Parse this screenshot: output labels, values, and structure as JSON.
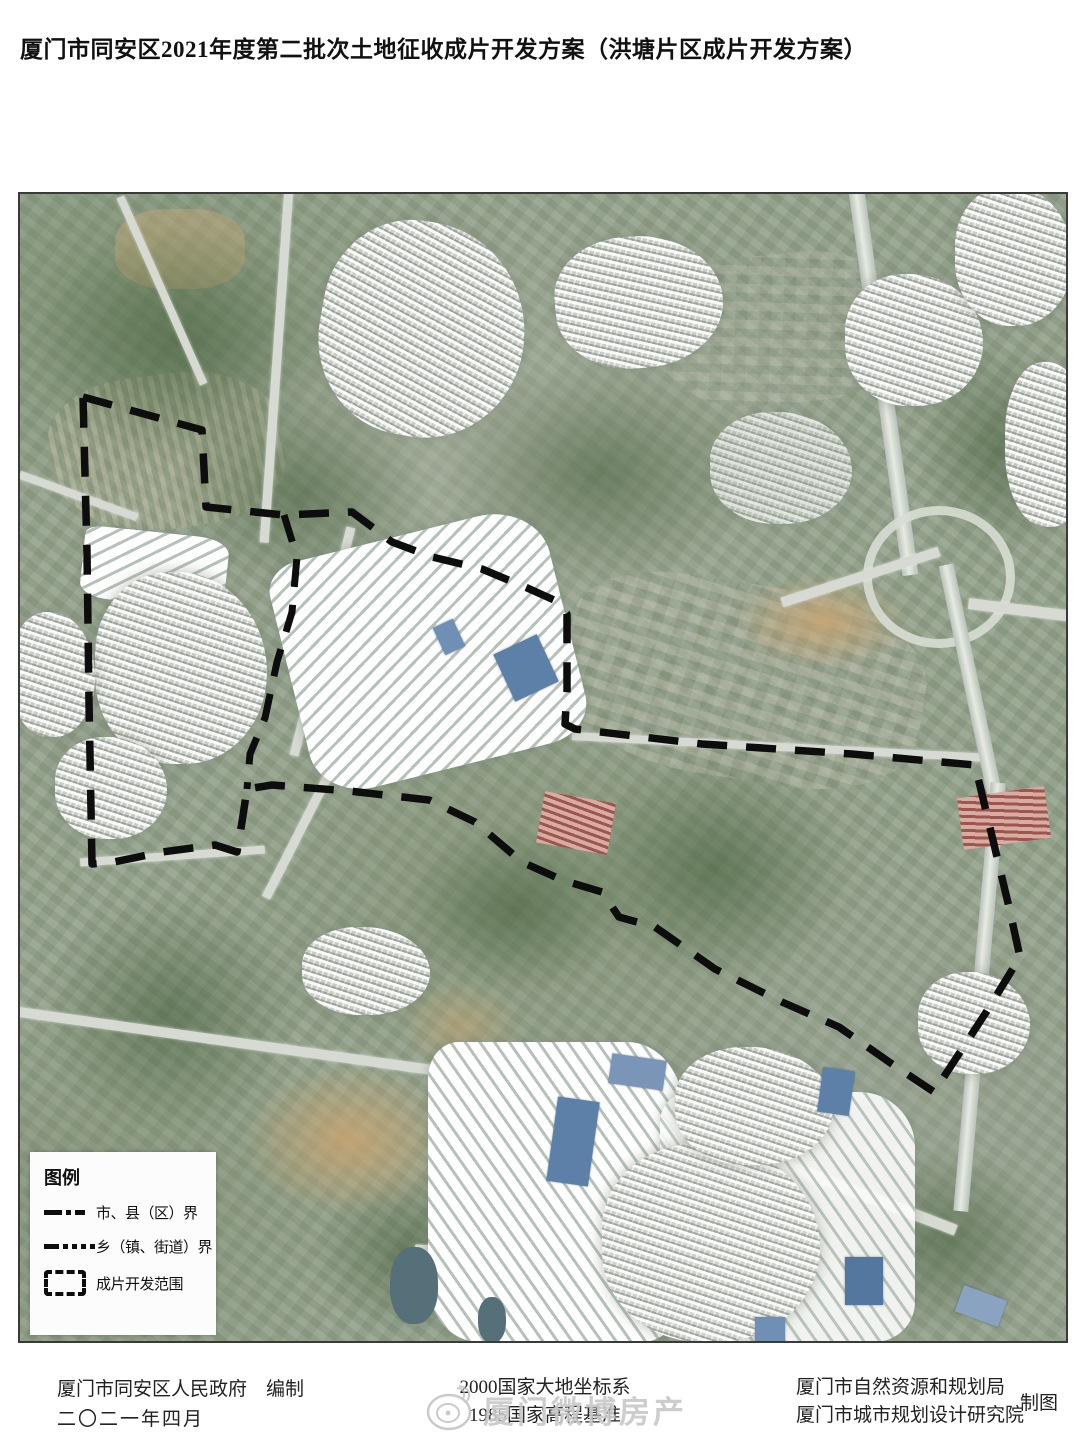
{
  "title": "厦门市同安区2021年度第二批次土地征收成片开发方案（洪塘片区成片开发方案）",
  "legend": {
    "heading": "图例",
    "items": [
      {
        "id": "city-county-boundary",
        "label": "市、县（区）界"
      },
      {
        "id": "township-boundary",
        "label": "乡（镇、街道）界"
      },
      {
        "id": "development-area",
        "label": "成片开发范围"
      }
    ]
  },
  "footer": {
    "left_line1": "厦门市同安区人民政府　编制",
    "left_line2": "二〇二一年四月",
    "center_line1": "2000国家大地坐标系",
    "center_line2": "1985国家高程基准",
    "right_line1": "厦门市自然资源和规划局",
    "right_line2": "厦门市城市规划设计研究院",
    "right_note": "制图"
  },
  "watermark": {
    "text": "厦门微博房产"
  },
  "map": {
    "boundary_color": "#0d0d0d",
    "description": "satellite-imagery-with-development-boundary"
  }
}
